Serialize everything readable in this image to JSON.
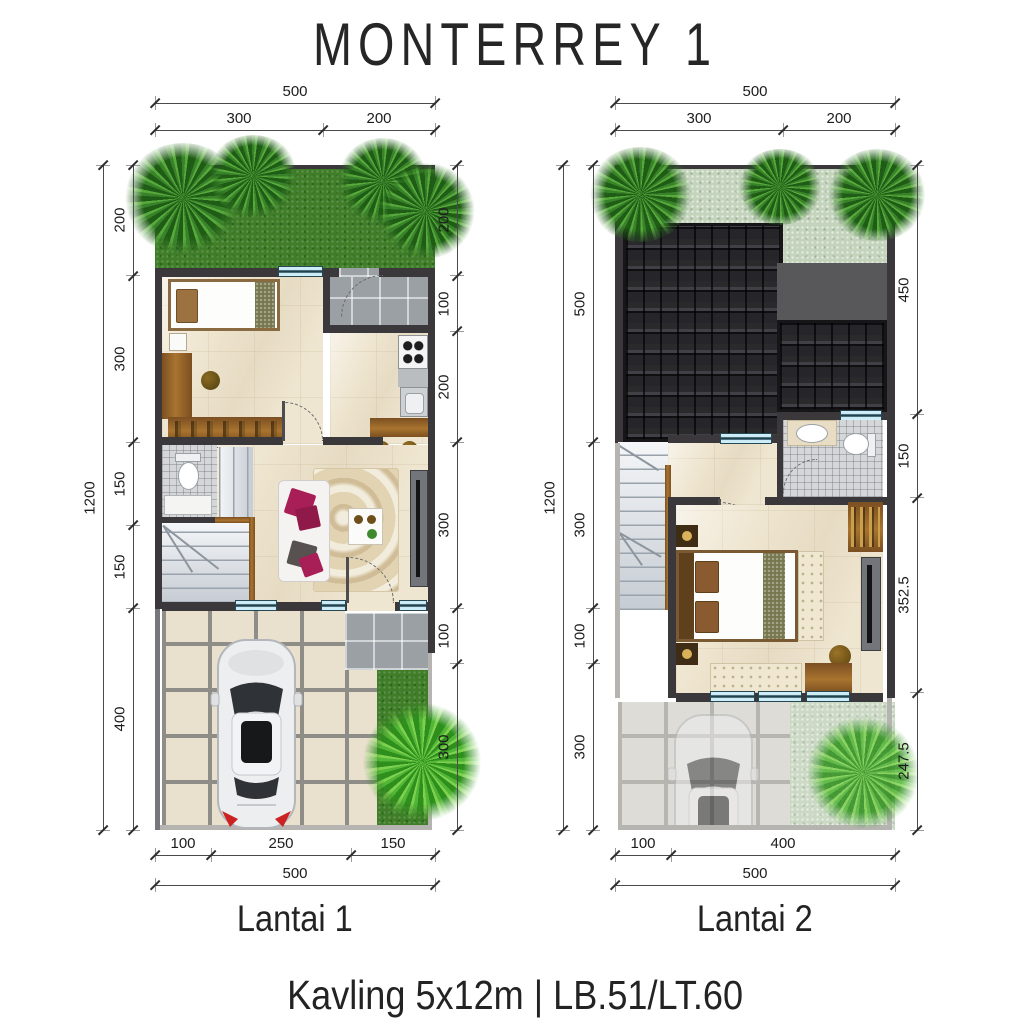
{
  "title": "MONTERREY 1",
  "caption": "Kavling 5x12m | LB.51/LT.60",
  "plans": [
    {
      "label": "Lantai 1",
      "dims": {
        "top_total": "500",
        "top_segments": [
          "300",
          "200"
        ],
        "left_total": "1200",
        "left_segments": [
          "200",
          "300",
          "150",
          "150",
          "400"
        ],
        "right_segments": [
          "200",
          "100",
          "200",
          "300",
          "100",
          "300"
        ],
        "bottom_segments": [
          "100",
          "250",
          "150"
        ],
        "bottom_total": "500"
      }
    },
    {
      "label": "Lantai 2",
      "dims": {
        "top_total": "500",
        "top_segments": [
          "300",
          "200"
        ],
        "left_total": "1200",
        "left_segments": [
          "500",
          "300",
          "100",
          "300"
        ],
        "right_segments": [
          "450",
          "150",
          "352.5",
          "247.5"
        ],
        "bottom_segments": [
          "100",
          "400"
        ],
        "bottom_total": "500"
      }
    }
  ],
  "colors": {
    "wall": "#3a383b",
    "grass": "#3f7d28",
    "pale_grass": "#c3d3bc",
    "roof": "#232325",
    "floor": "#efe6d1",
    "grey_tile": "#9aa0a4",
    "window": "#bfe9f5",
    "dim_line": "#4a4a4a",
    "sofa_pillow": "#a81e56",
    "wood": "#8a5a28"
  }
}
